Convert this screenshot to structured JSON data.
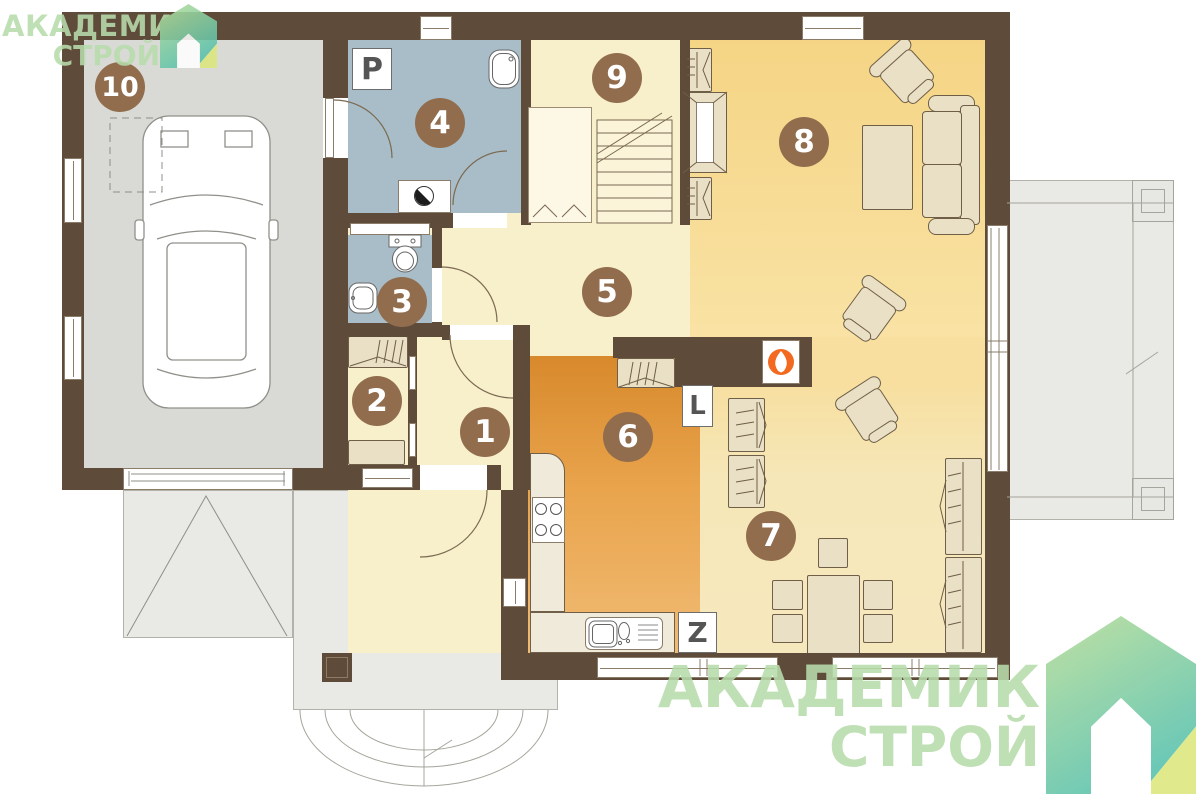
{
  "brand": {
    "line1": "АКАДЕМИК",
    "line2": "СТРОЙ"
  },
  "badges": [
    {
      "number": "1"
    },
    {
      "number": "2"
    },
    {
      "number": "3"
    },
    {
      "number": "4"
    },
    {
      "number": "5"
    },
    {
      "number": "6"
    },
    {
      "number": "7"
    },
    {
      "number": "8"
    },
    {
      "number": "9"
    },
    {
      "number": "10"
    }
  ],
  "appliance_labels": {
    "p": "P",
    "l": "L",
    "z": "Z"
  },
  "colors": {
    "wall_brown": "#5e4b3a",
    "badge_brown": "#916d4d",
    "room_blue": "#a9bdc8",
    "kitchen_orange": "#d8892c",
    "living_yellow": "#f5d585",
    "garage_gray": "#d9dad6",
    "logo_green": "#b7dcab",
    "flame_orange": "#f2691f"
  }
}
